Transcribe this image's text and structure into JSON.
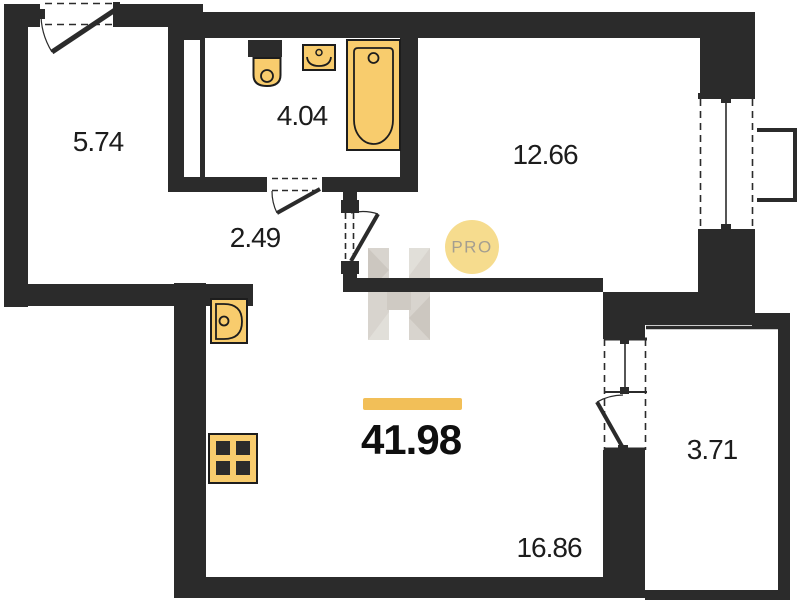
{
  "watermark": {
    "logo": "PRO"
  },
  "total_area": {
    "value": "41.98",
    "accent_color": "#f2bf58"
  },
  "rooms": [
    {
      "name": "entrance-hall",
      "area": "5.74"
    },
    {
      "name": "bathroom",
      "area": "4.04"
    },
    {
      "name": "corridor",
      "area": "2.49"
    },
    {
      "name": "bedroom",
      "area": "12.66"
    },
    {
      "name": "kitchen-living-room",
      "area": "16.86"
    },
    {
      "name": "balcony",
      "area": "3.71"
    }
  ],
  "fixtures": [
    "bathtub",
    "toilet",
    "washbasin",
    "kitchen-sink",
    "stove"
  ],
  "colors": {
    "walls": "#2b2b2b",
    "fixture_fill": "#f8cc6d",
    "accent_bar": "#f2bf58",
    "watermark_circle": "#f6dc8e",
    "watermark_gray": "#d8d4ce"
  }
}
